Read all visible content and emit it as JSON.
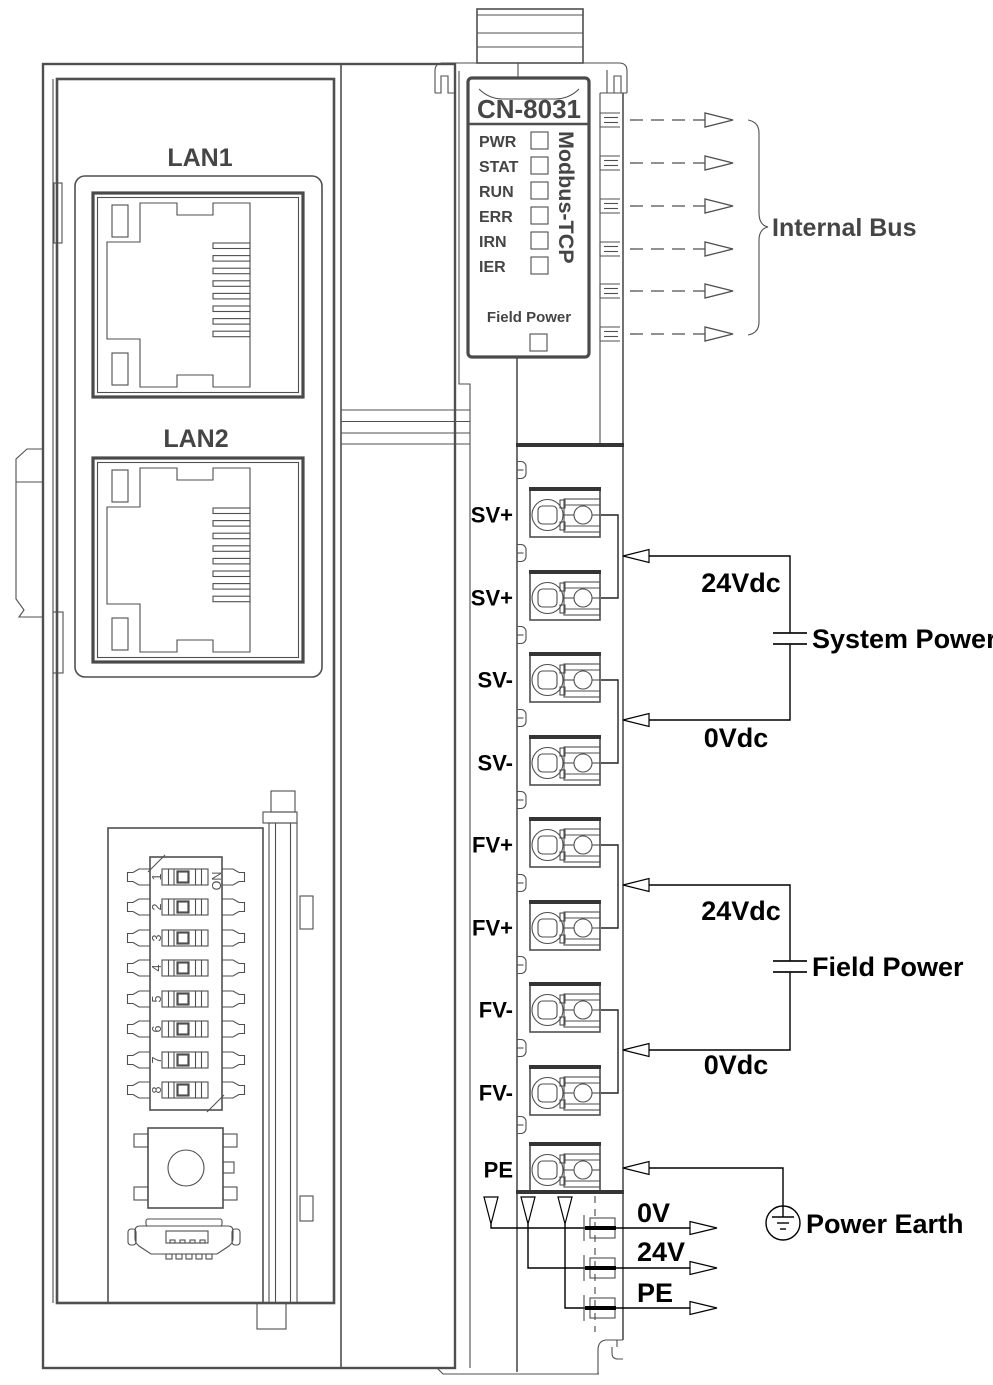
{
  "module": {
    "model": "CN-8031",
    "protocol": "Modbus-TCP",
    "leds": [
      "PWR",
      "STAT",
      "RUN",
      "ERR",
      "IRN",
      "IER"
    ],
    "field_power_led": "Field Power"
  },
  "lan": {
    "lan1": "LAN1",
    "lan2": "LAN2"
  },
  "dip": {
    "on": "ON",
    "numbers": [
      "1",
      "2",
      "3",
      "4",
      "5",
      "6",
      "7",
      "8"
    ]
  },
  "terminals": [
    "SV+",
    "SV+",
    "SV-",
    "SV-",
    "FV+",
    "FV+",
    "FV-",
    "FV-",
    "PE"
  ],
  "bus": {
    "label": "Internal Bus"
  },
  "system_power": {
    "plus": "24Vdc",
    "minus": "0Vdc",
    "label": "System Power"
  },
  "field_power": {
    "plus": "24Vdc",
    "minus": "0Vdc",
    "label": "Field Power"
  },
  "earth": {
    "label": "Power Earth"
  },
  "outputs": [
    "0V",
    "24V",
    "PE"
  ],
  "colors": {
    "device_line": "#4f4f4f",
    "wire": "#000000",
    "background": "#ffffff"
  }
}
